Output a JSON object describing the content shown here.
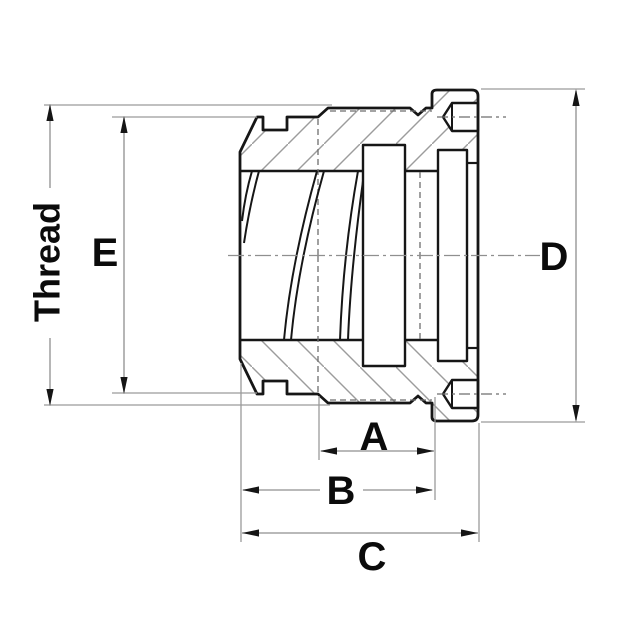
{
  "drawing": {
    "description": "Cross-section technical drawing of a hydraulic hose fitting swivel nut with internal thread, crimp collar and dimension callouts",
    "view": "side section view",
    "labels": {
      "thread": "Thread",
      "a": "A",
      "b": "B",
      "c": "C",
      "d": "D",
      "e": "E"
    },
    "dimension_meanings": {
      "thread": "thread outside diameter (vertical, far left)",
      "e": "hex flats height (vertical, left)",
      "d": "collar outside diameter (vertical, right)",
      "a": "length from hex step to collar notch (horizontal)",
      "b": "length from nut face to collar notch (horizontal)",
      "c": "overall length from nut face to collar face (horizontal)"
    },
    "colors": {
      "background": "#ffffff",
      "outline": "#161616",
      "dimension_lines": "#8f8f8f",
      "hatching": "#9c9c9c",
      "hidden_lines": "#6e6e6e",
      "label_text": "#0b0b0b"
    }
  }
}
